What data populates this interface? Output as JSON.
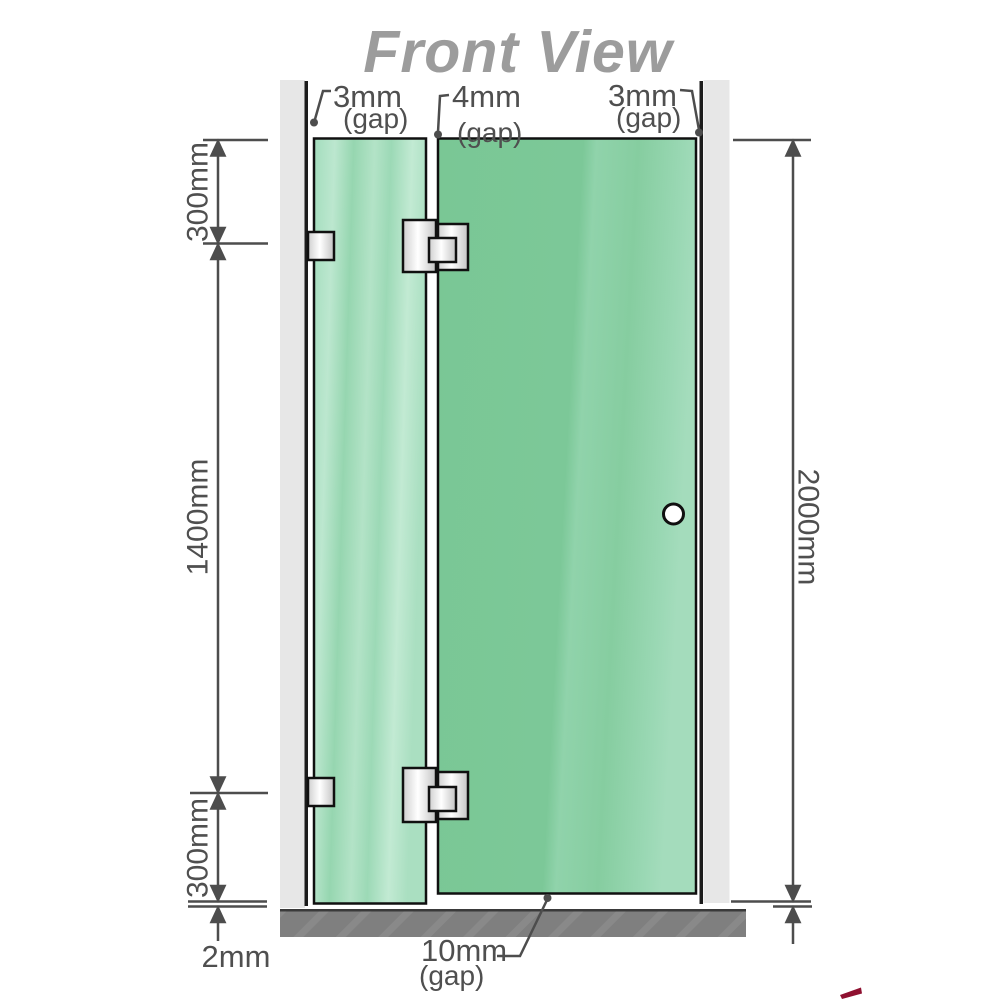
{
  "title": "Front View",
  "annotations": {
    "top_gaps": [
      {
        "value": "3mm",
        "suffix": "(gap)"
      },
      {
        "value": "4mm",
        "suffix": "(gap)"
      },
      {
        "value": "3mm",
        "suffix": "(gap)"
      }
    ],
    "bottom_gap": {
      "value": "10mm",
      "suffix": "(gap)"
    },
    "dimensions": {
      "left_top": "300mm",
      "left_middle": "1400mm",
      "left_bottom": "300mm",
      "floor_gap": "2mm",
      "right_total": "2000mm"
    }
  },
  "colors": {
    "glass_green": "#7cc898",
    "glass_green_light": "#93d4ac",
    "glass_green_pale": "#b7e5cb",
    "wall_channel": "#e7e7e7",
    "floor_gray": "#7f7f7f",
    "title_gray": "#9c9c9c",
    "dimension_gray": "#4d4d4d",
    "label_gray": "#4f4f4f",
    "outline_black": "#111111",
    "hardware_metal": "#e9e9e9",
    "knob_fill": "#ffffff",
    "logo_red": "#8f1030"
  }
}
